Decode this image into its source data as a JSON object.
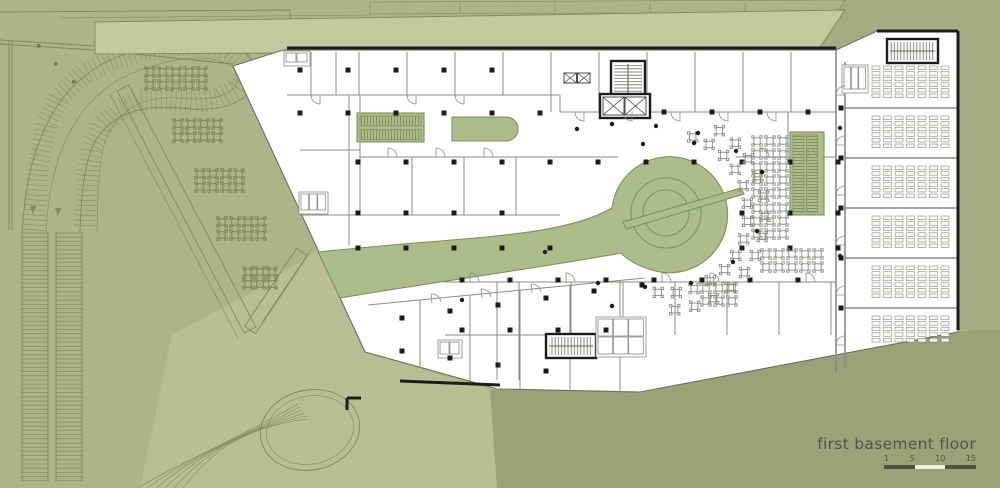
{
  "title_block": {
    "title": "first basement floor",
    "scale": {
      "ticks": [
        "1",
        "5",
        "10",
        "15"
      ],
      "segments": [
        "dark",
        "light",
        "dark"
      ]
    }
  },
  "colors": {
    "site_green": "#aeb489",
    "site_green_light": "#b8bf94",
    "site_green_dark": "#9aa377",
    "wedge_green": "#a4ac81",
    "canopy_green": "#c2caa0",
    "canopy_green_upper": "#b7bf95",
    "interior_green": "#adbc8b",
    "interior_green_line": "#7f905c",
    "plan_white": "#ffffff",
    "wall_gray": "#8b8b85",
    "line_site": "#7d8a5c",
    "ink_black": "#1c1c1a",
    "text_color": "#4f5447",
    "scale_light": "#eef0e0"
  }
}
